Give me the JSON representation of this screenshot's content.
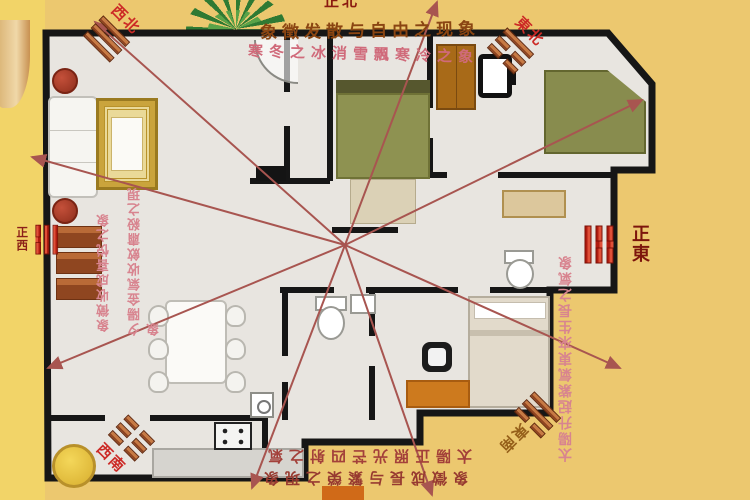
{
  "scene": {
    "bg_outer": "#ecc86f",
    "floor": "#e8e5e0",
    "wall": "#161616",
    "ray_color": "#a85550"
  },
  "banner": {
    "line1": "象徵发散与自由之现象",
    "line2": "寒冬之冰消雪飄寒冷之象"
  },
  "compass": {
    "north": "正北",
    "northeast": "東北",
    "east": "正東",
    "southeast": "東南",
    "south": "正南",
    "southwest": "西南",
    "west": "正西",
    "northwest": "西北"
  },
  "annotations": {
    "west_col_short": "象徵收成喜悦之象",
    "west_col_long": "夕陽金氣收斂肅殺之現象",
    "east_col": "太陽升起紫氣東來生長之氣象",
    "south_line1": "太陽正照光芒四射之氣",
    "south_line2": "象徵成長与繁榮之現象"
  }
}
